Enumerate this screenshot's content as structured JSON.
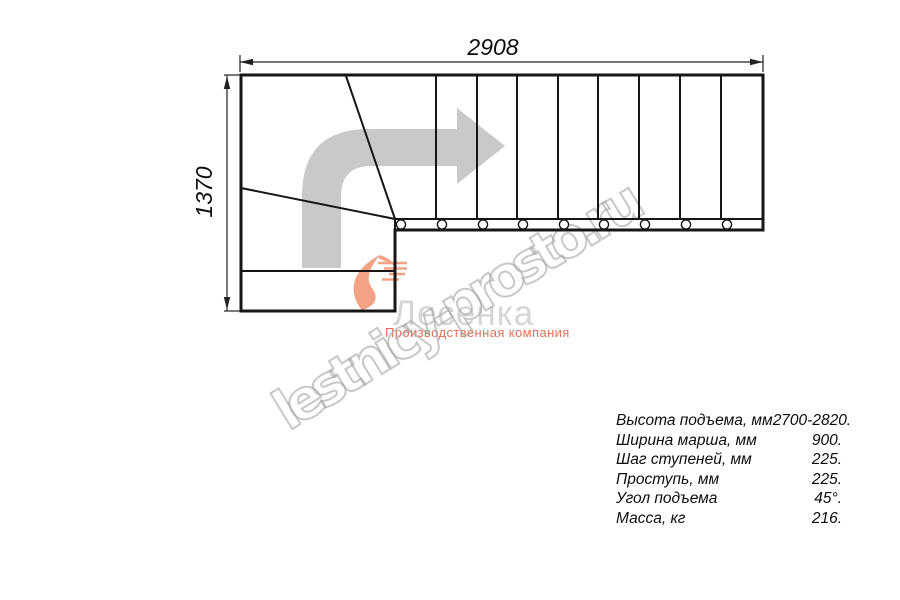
{
  "drawing": {
    "width_label": "2908",
    "height_label": "1370",
    "straight_steps": 9,
    "winder_steps": 3,
    "fastener_circles": 9
  },
  "watermark": {
    "text": "lestnicy-prosto.ru"
  },
  "logo": {
    "name": "Лесенка",
    "tagline": "Производственная компания"
  },
  "specs": {
    "rows": [
      {
        "label": "Высота подъема, мм",
        "value": "2700-2820."
      },
      {
        "label": "Ширина марша, мм",
        "value": "900."
      },
      {
        "label": "Шаг ступеней, мм",
        "value": "225."
      },
      {
        "label": "Проступь, мм",
        "value": "225."
      },
      {
        "label": "Угол подъема",
        "value": "45°."
      },
      {
        "label": "Масса, кг",
        "value": "216."
      }
    ]
  },
  "colors": {
    "line_black": "#161616",
    "dimension_gray": "#222222",
    "arrow_gray": "#c9c9c9",
    "brand_salmon": "#f3a285",
    "brand_red": "#e4705a",
    "logo_text_gray": "#d6d6d6",
    "watermark_gray": "#a6a6a6"
  }
}
